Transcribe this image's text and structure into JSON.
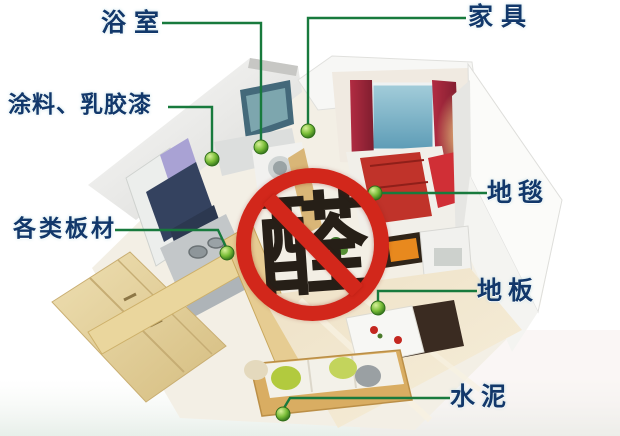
{
  "diagram": {
    "title_meaning": "sources of formaldehyde in a home",
    "ban_character": "醛",
    "labels": {
      "bathroom": "浴室",
      "furniture": "家具",
      "paint_latex": "涂料、乳胶漆",
      "boards": "各类板材",
      "carpet": "地毯",
      "floor": "地板",
      "cement": "水泥"
    },
    "colors": {
      "label_text": "#12386b",
      "connector_green": "#187a3d",
      "marker_green": "#79bd37",
      "ban_red": "#d2271b",
      "ban_character_color": "#261f17"
    }
  }
}
